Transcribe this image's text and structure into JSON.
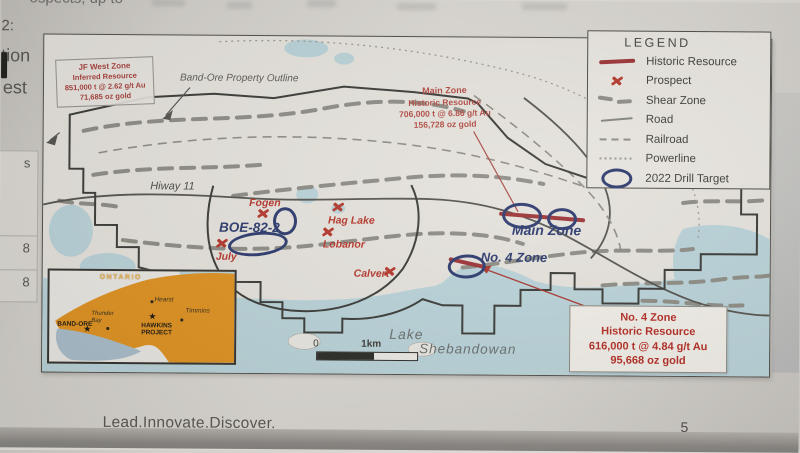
{
  "page": {
    "top_fragment": "ospects, up to",
    "margin_fragments": {
      "a": "2:",
      "b": "tion",
      "c": "est"
    },
    "table_fragment": {
      "r0": "s",
      "r1": "8",
      "r2": "8"
    },
    "footer": {
      "tagline": "Lead.Innovate.Discover.",
      "page_number": "5"
    }
  },
  "map": {
    "annotations": {
      "property_outline_label": "Band-Ore Property Outline",
      "road_label": "Hiway 11",
      "lake_label_line1": "Lake",
      "lake_label_line2": "Shebandowan"
    },
    "scale_bar": {
      "zero": "0",
      "one_km": "1km"
    },
    "resource_boxes": {
      "jf_west": {
        "title": "JF West Zone",
        "subtitle": "Inferred Resource",
        "tonnage": "851,000 t @ 2.62 g/t Au",
        "ounces": "71,685 oz gold"
      },
      "main_zone": {
        "title": "Main Zone",
        "subtitle": "Historic Resource",
        "tonnage": "706,000 t @ 6.86 g/t Au",
        "ounces": "156,728 oz gold"
      },
      "no4_zone": {
        "title": "No. 4 Zone",
        "subtitle": "Historic Resource",
        "tonnage": "616,000 t @ 4.84 g/t Au",
        "ounces": "95,668 oz gold"
      }
    },
    "zones": {
      "boe": "BOE-82-2",
      "main": "Main Zone",
      "no4": "No. 4 Zone"
    },
    "prospects": {
      "fogen": "Fogen",
      "hag_lake": "Hag Lake",
      "lobanor": "Lobanor",
      "july": "July",
      "calvert": "Calvert"
    },
    "legend": {
      "title": "LEGEND",
      "items": [
        {
          "name": "historic-resource",
          "label": "Historic Resource"
        },
        {
          "name": "prospect",
          "label": "Prospect"
        },
        {
          "name": "shear-zone",
          "label": "Shear Zone"
        },
        {
          "name": "road",
          "label": "Road"
        },
        {
          "name": "railroad",
          "label": "Railroad"
        },
        {
          "name": "powerline",
          "label": "Powerline"
        },
        {
          "name": "drill-target",
          "label": "2022 Drill Target"
        }
      ]
    },
    "inset": {
      "province": "ONTARIO",
      "star": "★",
      "places": {
        "hearst": "Hearst",
        "timmins": "Timmins",
        "thunder_bay": "Thunder Bay",
        "band_ore": "BAND-ORE",
        "hawkins": "HAWKINS PROJECT"
      }
    },
    "colors": {
      "resource_red": "#9c3336",
      "prospect_red": "#b5372c",
      "drill_target_navy": "#2d3a6d",
      "water_blue": "#b9d2d8",
      "ontario_orange": "#df9221",
      "shear_gray": "#8d8d85"
    }
  }
}
